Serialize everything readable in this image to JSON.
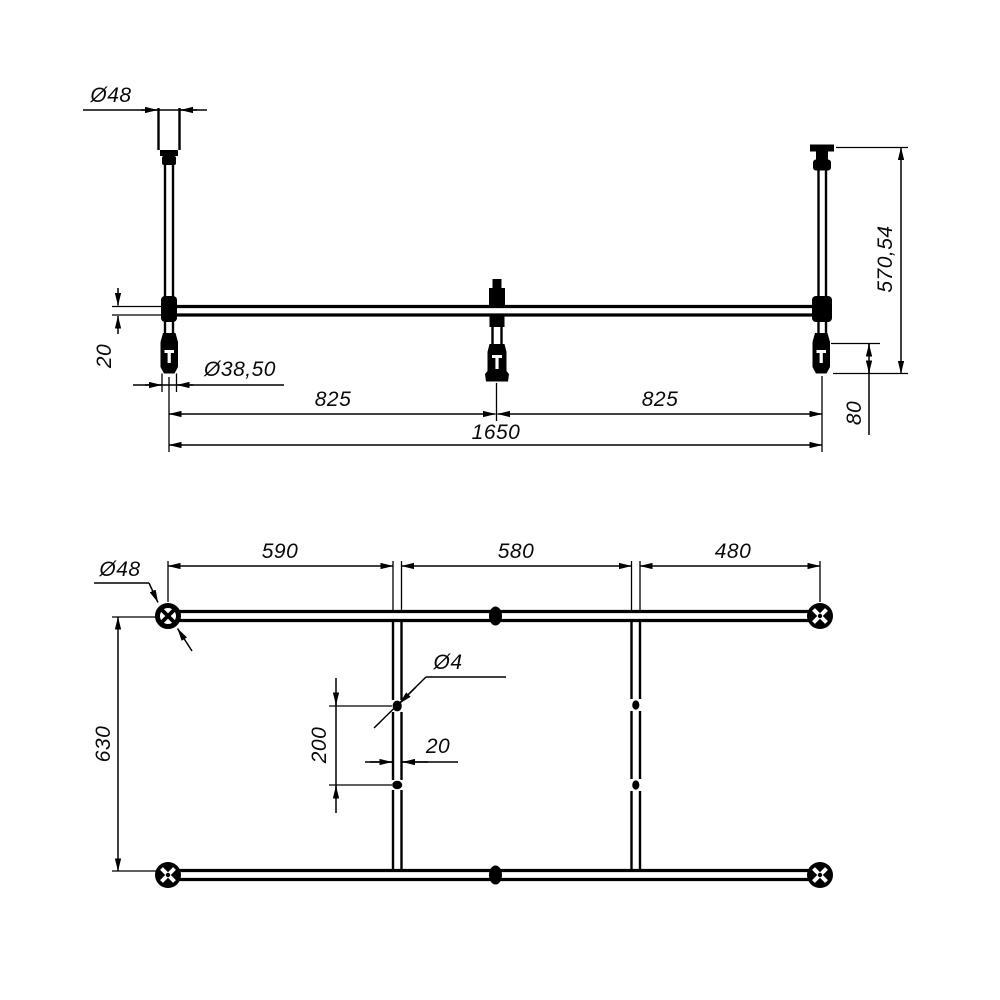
{
  "colors": {
    "background": "#ffffff",
    "line": "#000000"
  },
  "views": {
    "elevation": {
      "dims": {
        "sleeve_diameter": "Ø48",
        "tube_size": "20",
        "foot_diameter": "Ø38,50",
        "span_left": "825",
        "span_right": "825",
        "span_total": "1650",
        "height": "570,54",
        "foot_adjust_height": "80"
      }
    },
    "plan": {
      "dims": {
        "foot_diameter": "Ø48",
        "segment_left": "590",
        "segment_middle": "580",
        "segment_right": "480",
        "depth": "630",
        "hole_diameter": "Ø4",
        "hole_spacing": "200",
        "tube_size": "20"
      }
    }
  }
}
